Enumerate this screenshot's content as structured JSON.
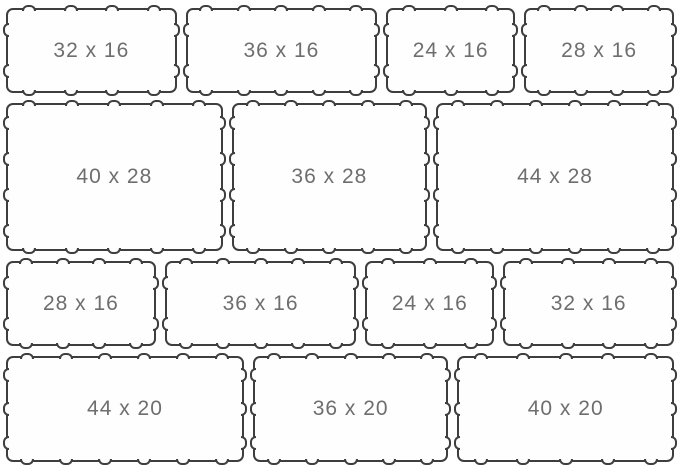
{
  "pattern": {
    "rows": [
      {
        "tiles": [
          {
            "label": "32 x 16",
            "w": 32,
            "h": 16
          },
          {
            "label": "36 x 16",
            "w": 36,
            "h": 16
          },
          {
            "label": "24 x 16",
            "w": 24,
            "h": 16
          },
          {
            "label": "28 x 16",
            "w": 28,
            "h": 16
          }
        ]
      },
      {
        "tiles": [
          {
            "label": "40 x 28",
            "w": 40,
            "h": 28
          },
          {
            "label": "36 x 28",
            "w": 36,
            "h": 28
          },
          {
            "label": "44 x 28",
            "w": 44,
            "h": 28
          }
        ]
      },
      {
        "tiles": [
          {
            "label": "28 x 16",
            "w": 28,
            "h": 16
          },
          {
            "label": "36 x 16",
            "w": 36,
            "h": 16
          },
          {
            "label": "24 x 16",
            "w": 24,
            "h": 16
          },
          {
            "label": "32 x 16",
            "w": 32,
            "h": 16
          }
        ]
      },
      {
        "tiles": [
          {
            "label": "44 x 20",
            "w": 44,
            "h": 20
          },
          {
            "label": "36 x 20",
            "w": 36,
            "h": 20
          },
          {
            "label": "40 x 20",
            "w": 40,
            "h": 20
          }
        ]
      }
    ]
  },
  "colors": {
    "tile_border": "#3e3e3e",
    "tile_fill": "#fefefe",
    "label_text": "#6e6e6e",
    "background": "#ffffff"
  }
}
